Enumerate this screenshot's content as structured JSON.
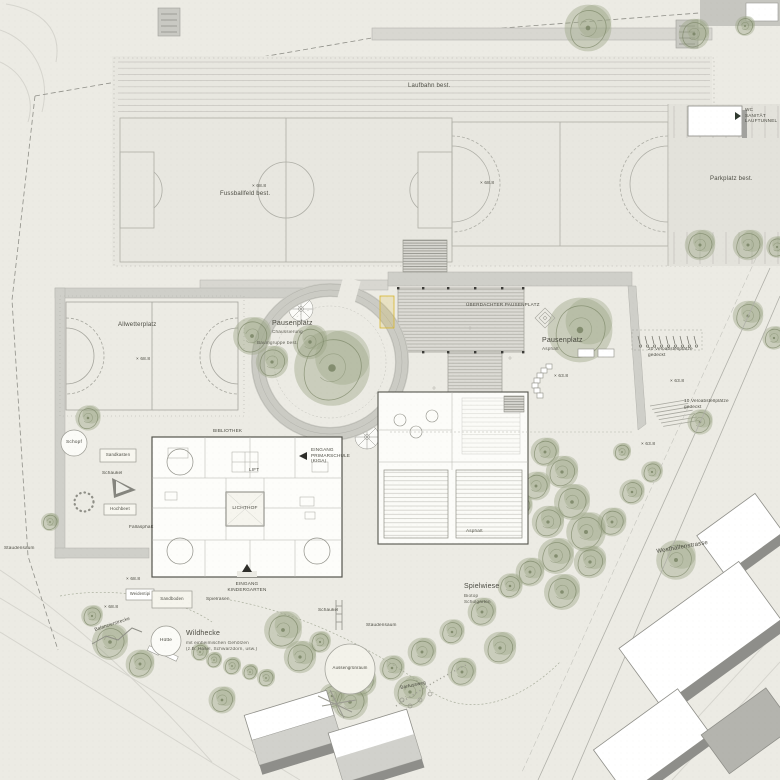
{
  "labels": {
    "laufbahn": "Laufbahn best.",
    "fussballfeld": "Fussballfeld best.",
    "parkplatz": "Parkplatz best.",
    "sanitaet_l1": "WC",
    "sanitaet_l2": "SANITÄT",
    "sanitaet_l3": "LAUFTUNNEL",
    "allwetterplatz": "Allwetterplatz",
    "pausenplatz_west": "Pausenplatz",
    "pausenplatz_west_sub": "Chaussierung",
    "baumgruppe": "Baumgruppe best.",
    "pausenplatz_ost": "Pausenplatz",
    "pausenplatz_ost_sub": "Asphalt",
    "ueberdachter_pausenplatz": "ÜBERDACHTER PAUSENPLATZ",
    "bibliothek": "BIBLIOTHEK",
    "lichthof": "LICHTHOF",
    "lift": "LIFT",
    "eingang_prim_l1": "EINGANG",
    "eingang_prim_l2": "PRIMARSCHULE",
    "eingang_prim_l3": "(KIGA)",
    "eingang_kiga_l1": "EINGANG",
    "eingang_kiga_l2": "KINDERGARTEN",
    "asphalt": "Asphalt",
    "velo20_l1": "20 Veloabstellplätze",
    "velo20_l2": "gedeckt",
    "velo10_l1": "10 Veloabstellplätze",
    "velo10_l2": "gedeckt",
    "westhallenstrasse": "Westhallenstrasse",
    "schopf": "Schopf",
    "sandkasten": "Sandkasten",
    "schaukel1": "Schaukel",
    "hochbeet": "Hochbeet",
    "fallasphalt": "Fallasphalt",
    "weidentipi": "Weidentipi",
    "sandboden": "Sandboden",
    "spielrasen": "Spielrasen",
    "balancierstrecke": "Balancierstrecke",
    "huette": "Hütte",
    "wildhecke": "Wildhecke",
    "wildhecke_sub1": "mit einheimischen Gehölzen",
    "wildhecke_sub2": "(z.B. Hasel, Schwarzdorn, usw.)",
    "schaukel2": "Schaukel",
    "staudensaum1": "Staudensaum",
    "staudensaum2": "Staudensaum",
    "aussengruenraum": "Aussengrünraum",
    "barfussweg": "Barfussweg",
    "spielwiese": "Spielwiese",
    "spielwiese_sub1": "Biotop",
    "spielwiese_sub2": "Schulgarten"
  },
  "elev": {
    "e1": "× 68.8",
    "e2": "× 68.8",
    "e3": "× 68.8",
    "e4": "× 63.8",
    "e5": "× 63.8",
    "e6": "× 63.8",
    "e7": "× 68.8",
    "e8": "× 68.8"
  },
  "colors": {
    "paper": "#ecebe4",
    "field": "#e8e7e0",
    "canopy": "#dcdbd5",
    "gray": "#cfcfc9",
    "wall": "#b2b2ac",
    "line": "#a6a69e",
    "tree": "#9aa585",
    "treedark": "#768161",
    "yellow": "#d9b72e",
    "shadow": "#8e8e8a",
    "white": "#fdfdfa",
    "text": "#4b4b42"
  }
}
